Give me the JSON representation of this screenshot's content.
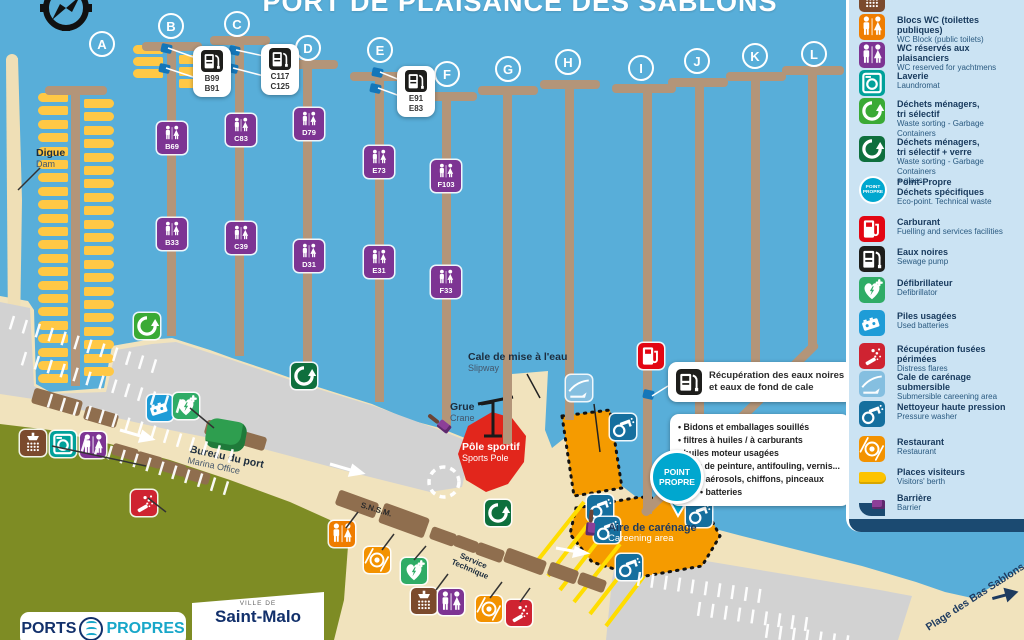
{
  "title": "PORT DE PLAISANCE DES SABLONS",
  "colors": {
    "water": "#58aed9",
    "sand": "#f1e3bd",
    "pontoon": "#b39579",
    "parking": "#d2d2d2",
    "grass": "#7e8c24",
    "legend_bg": "#cbe3f3",
    "navy": "#17395c",
    "orange_zone": "#f59b00",
    "red_zone": "#e2261c",
    "berth_yellow": "#ffc845"
  },
  "legend": {
    "badge1": "POINT",
    "badge2": "PROPRE",
    "items": [
      {
        "icon": "shower",
        "color": "#7b4a2d",
        "top": 0,
        "fr": "",
        "en": "Sanitary"
      },
      {
        "icon": "wc",
        "color": "#ef7d00",
        "top": 28,
        "fr": "Blocs WC (toilettes publiques)",
        "en": "WC Block (public toilets)"
      },
      {
        "icon": "wc",
        "color": "#7d3493",
        "top": 56,
        "fr": "WC réservés aux plaisanciers",
        "en": "WC reserved for yachtmens"
      },
      {
        "icon": "laundry",
        "color": "#00a19a",
        "top": 84,
        "fr": "Laverie",
        "en": "Laundromat"
      },
      {
        "icon": "recycle",
        "color": "#3aaa35",
        "top": 112,
        "fr": "Déchets ménagers,",
        "fr2": "tri sélectif",
        "en": "Waste sorting - Garbage Containers"
      },
      {
        "icon": "recycle",
        "color": "#0e6f3d",
        "top": 150,
        "fr": "Déchets ménagers,",
        "fr2": "tri sélectif + verre",
        "en": "Waste sorting - Garbage Containers",
        "en2": "+ glass"
      },
      {
        "icon": "pointpropre",
        "color": "#00a7cf",
        "top": 190,
        "fr": "Point-Propre",
        "fr2": "Déchets spécifiques",
        "en": "Eco-point. Technical waste"
      },
      {
        "icon": "fuel",
        "color": "#e30613",
        "top": 230,
        "fr": "Carburant",
        "en": "Fuelling and services facilities"
      },
      {
        "icon": "sewage",
        "color": "#1d1d1b",
        "top": 260,
        "fr": "Eaux noires",
        "en": "Sewage pump"
      },
      {
        "icon": "defib",
        "color": "#2fac66",
        "top": 291,
        "fr": "Défibrillateur",
        "en": "Defibrillator"
      },
      {
        "icon": "battery",
        "color": "#1e9cd7",
        "top": 324,
        "fr": "Piles usagées",
        "en": "Used batteries"
      },
      {
        "icon": "flares",
        "color": "#cf2331",
        "top": 357,
        "fr": "Récupération fusées périmées",
        "en": "Distress flares"
      },
      {
        "icon": "slipway",
        "color": "#85bfe0",
        "top": 385,
        "fr": "Cale de carénage submersible",
        "en": "Submersible careening area"
      },
      {
        "icon": "washer",
        "color": "#156f9e",
        "top": 415,
        "fr": "Nettoyeur haute pression",
        "en": "Pressure washer"
      },
      {
        "icon": "restaurant",
        "color": "#f39200",
        "top": 450,
        "fr": "Restaurant",
        "en": "Restaurant"
      },
      {
        "icon": "berth",
        "color": "#fdc300",
        "top": 480,
        "fr": "Places visiteurs",
        "en": "Visitors' berth"
      },
      {
        "icon": "barrier",
        "color": "#7d3493",
        "top": 506,
        "fr": "Barrière",
        "en": "Barrier"
      }
    ]
  },
  "map_labels": {
    "digue_fr": "Digue",
    "digue_en": "Dam",
    "slipway_fr": "Cale de mise à l'eau",
    "slipway_en": "Slipway",
    "crane_fr": "Grue",
    "crane_en": "Crane",
    "sports_fr": "Pôle sportif",
    "sports_en": "Sports Pole",
    "careening_fr": "Aire de carénage",
    "careening_en": "Careening area",
    "office_fr": "Bureau du port",
    "office_en": "Marina Office",
    "snsm": "S.N.S.M.",
    "service_1": "Service",
    "service_2": "Technique",
    "beach": "Plage des Bas Sablons",
    "badge1": "POINT",
    "badge2": "PROPRE"
  },
  "callouts": {
    "recup_line1": "Récupération des eaux noires",
    "recup_line2": "et eaux de fond de cale",
    "waste_list": [
      "Bidons et emballages souillés",
      "filtres à huiles / à carburants",
      "huiles moteur usagées",
      "pots de peinture, antifouling, vernis...",
      "aérosols, chiffons, pinceaux",
      "batteries"
    ],
    "berth_callouts": [
      {
        "labels": [
          "B99",
          "B91"
        ],
        "x": 193,
        "y": 46
      },
      {
        "labels": [
          "C117",
          "C125"
        ],
        "x": 261,
        "y": 44
      },
      {
        "labels": [
          "E91",
          "E83"
        ],
        "x": 397,
        "y": 66
      }
    ]
  },
  "footer": {
    "pp1": "PORTS",
    "pp2": "PROPRES",
    "ville": "VILLE DE",
    "city": "Saint-Malo"
  },
  "map": {
    "letters": [
      {
        "t": "A",
        "x": 89,
        "y": 31
      },
      {
        "t": "B",
        "x": 158,
        "y": 13
      },
      {
        "t": "C",
        "x": 224,
        "y": 11
      },
      {
        "t": "D",
        "x": 295,
        "y": 35
      },
      {
        "t": "E",
        "x": 367,
        "y": 37
      },
      {
        "t": "F",
        "x": 434,
        "y": 61
      },
      {
        "t": "G",
        "x": 495,
        "y": 56
      },
      {
        "t": "H",
        "x": 555,
        "y": 49
      },
      {
        "t": "I",
        "x": 628,
        "y": 55
      },
      {
        "t": "J",
        "x": 684,
        "y": 48
      },
      {
        "t": "K",
        "x": 742,
        "y": 43
      },
      {
        "t": "L",
        "x": 801,
        "y": 41
      }
    ],
    "pontoons": [
      {
        "bx": 45,
        "by": 86,
        "bw": 62,
        "sx": 71,
        "sy": 86,
        "sl": 300
      },
      {
        "bx": 142,
        "by": 42,
        "bw": 60,
        "sx": 167,
        "sy": 42,
        "sl": 294
      },
      {
        "bx": 210,
        "by": 36,
        "bw": 60,
        "sx": 235,
        "sy": 36,
        "sl": 320
      },
      {
        "bx": 278,
        "by": 60,
        "bw": 60,
        "sx": 303,
        "sy": 60,
        "sl": 318
      },
      {
        "bx": 350,
        "by": 72,
        "bw": 60,
        "sx": 375,
        "sy": 72,
        "sl": 330
      },
      {
        "bx": 417,
        "by": 92,
        "bw": 60,
        "sx": 442,
        "sy": 92,
        "sl": 334
      },
      {
        "bx": 478,
        "by": 86,
        "bw": 60,
        "sx": 503,
        "sy": 86,
        "sl": 358
      },
      {
        "bx": 540,
        "by": 80,
        "bw": 60,
        "sx": 565,
        "sy": 80,
        "sl": 340
      },
      {
        "bx": 612,
        "by": 84,
        "bw": 64,
        "sx": 643,
        "sy": 84,
        "sl": 430
      },
      {
        "bx": 668,
        "by": 78,
        "bw": 60,
        "sx": 695,
        "sy": 78,
        "sl": 384
      },
      {
        "bx": 726,
        "by": 72,
        "bw": 60,
        "sx": 751,
        "sy": 72,
        "sl": 330
      },
      {
        "bx": 782,
        "by": 66,
        "bw": 62,
        "sx": 808,
        "sy": 66,
        "sl": 280
      }
    ],
    "walkway": {
      "x": 643,
      "y": 510,
      "len": 244,
      "rot": -44.6
    },
    "wc_markers": [
      {
        "label": "B69",
        "x": 157,
        "y": 122
      },
      {
        "label": "C83",
        "x": 226,
        "y": 114
      },
      {
        "label": "D79",
        "x": 294,
        "y": 108
      },
      {
        "label": "E73",
        "x": 364,
        "y": 146
      },
      {
        "label": "F103",
        "x": 431,
        "y": 160
      },
      {
        "label": "B33",
        "x": 157,
        "y": 218
      },
      {
        "label": "C39",
        "x": 226,
        "y": 222
      },
      {
        "label": "D31",
        "x": 294,
        "y": 240
      },
      {
        "label": "E31",
        "x": 364,
        "y": 246
      },
      {
        "label": "F33",
        "x": 431,
        "y": 266
      }
    ],
    "icons": [
      {
        "t": "recycle",
        "x": 134,
        "y": 313
      },
      {
        "t": "recycle2",
        "x": 291,
        "y": 363
      },
      {
        "t": "battery",
        "x": 147,
        "y": 395
      },
      {
        "t": "defib",
        "x": 173,
        "y": 393
      },
      {
        "t": "shower",
        "x": 20,
        "y": 430
      },
      {
        "t": "laundry",
        "x": 50,
        "y": 431
      },
      {
        "t": "wc",
        "x": 80,
        "y": 432
      },
      {
        "t": "flares",
        "x": 131,
        "y": 490
      },
      {
        "t": "wcpub",
        "x": 329,
        "y": 521
      },
      {
        "t": "restaurant",
        "x": 364,
        "y": 547
      },
      {
        "t": "defib",
        "x": 401,
        "y": 558
      },
      {
        "t": "shower",
        "x": 411,
        "y": 588
      },
      {
        "t": "wc",
        "x": 438,
        "y": 589
      },
      {
        "t": "restaurant",
        "x": 476,
        "y": 596
      },
      {
        "t": "flares",
        "x": 506,
        "y": 600
      },
      {
        "t": "recycle2",
        "x": 485,
        "y": 500
      },
      {
        "t": "fuel",
        "x": 638,
        "y": 343
      },
      {
        "t": "washer",
        "x": 587,
        "y": 495
      },
      {
        "t": "washer",
        "x": 594,
        "y": 517
      },
      {
        "t": "washer",
        "x": 616,
        "y": 554
      },
      {
        "t": "washer",
        "x": 686,
        "y": 501
      },
      {
        "t": "washer",
        "x": 610,
        "y": 414
      },
      {
        "t": "slipway",
        "x": 566,
        "y": 375
      }
    ],
    "icon_colors": {
      "wc": "#7d3493",
      "wcpub": "#ef7d00",
      "laundry": "#00a19a",
      "recycle": "#3aaa35",
      "recycle2": "#0e6f3d",
      "fuel": "#e30613",
      "sewage": "#1d1d1b",
      "defib": "#2fac66",
      "battery": "#1e9cd7",
      "flares": "#cf2331",
      "slipway": "#85bfe0",
      "washer": "#156f9e",
      "restaurant": "#f39200",
      "shower": "#7b4a2d"
    },
    "blue_markers": [
      {
        "x": 161,
        "y": 44
      },
      {
        "x": 159,
        "y": 64
      },
      {
        "x": 229,
        "y": 46
      },
      {
        "x": 227,
        "y": 64
      },
      {
        "x": 372,
        "y": 68
      },
      {
        "x": 370,
        "y": 84
      },
      {
        "x": 643,
        "y": 390
      }
    ],
    "barriers": [
      {
        "x": 426,
        "y": 418,
        "rot": 38
      },
      {
        "x": 578,
        "y": 518,
        "rot": 95
      }
    ],
    "buildings": [
      {
        "x": 32,
        "y": 394,
        "w": 50,
        "h": 16,
        "r": 16
      },
      {
        "x": 84,
        "y": 410,
        "w": 34,
        "h": 14,
        "r": 16
      },
      {
        "x": 112,
        "y": 446,
        "w": 26,
        "h": 12,
        "r": 16
      },
      {
        "x": 136,
        "y": 454,
        "w": 26,
        "h": 12,
        "r": 16
      },
      {
        "x": 160,
        "y": 462,
        "w": 26,
        "h": 12,
        "r": 16
      },
      {
        "x": 184,
        "y": 470,
        "w": 26,
        "h": 12,
        "r": 16
      },
      {
        "x": 205,
        "y": 424,
        "w": 36,
        "h": 15,
        "r": 16
      },
      {
        "x": 240,
        "y": 434,
        "w": 26,
        "h": 14,
        "r": 16
      },
      {
        "x": 336,
        "y": 496,
        "w": 42,
        "h": 16,
        "r": 20
      },
      {
        "x": 380,
        "y": 510,
        "w": 48,
        "h": 21,
        "r": 20
      },
      {
        "x": 430,
        "y": 530,
        "w": 26,
        "h": 13,
        "r": 20
      },
      {
        "x": 454,
        "y": 538,
        "w": 24,
        "h": 12,
        "r": 20
      },
      {
        "x": 476,
        "y": 546,
        "w": 28,
        "h": 13,
        "r": 20
      },
      {
        "x": 504,
        "y": 554,
        "w": 42,
        "h": 15,
        "r": 20
      },
      {
        "x": 548,
        "y": 566,
        "w": 30,
        "h": 14,
        "r": 20
      },
      {
        "x": 578,
        "y": 576,
        "w": 28,
        "h": 13,
        "r": 20
      }
    ],
    "boat_rows": [
      {
        "x": 38,
        "y": 93,
        "n": 22,
        "dy": 13.4,
        "dir": "r"
      },
      {
        "x": 84,
        "y": 99,
        "n": 21,
        "dy": 13.4,
        "dir": "l"
      },
      {
        "x": 133,
        "y": 45,
        "n": 3,
        "dy": 12,
        "dir": "r"
      },
      {
        "x": 179,
        "y": 55,
        "n": 3,
        "dy": 12,
        "dir": "l"
      }
    ],
    "stripe_rows": [
      {
        "x": 14,
        "y": 316,
        "n": 12,
        "a": 17
      },
      {
        "x": 26,
        "y": 352,
        "n": 13,
        "a": 17
      },
      {
        "x": 52,
        "y": 394,
        "n": 15,
        "a": 17
      },
      {
        "x": 86,
        "y": 438,
        "n": 12,
        "a": 17
      },
      {
        "x": 640,
        "y": 572,
        "n": 10,
        "a": 8
      },
      {
        "x": 700,
        "y": 602,
        "n": 9,
        "a": 8
      },
      {
        "x": 768,
        "y": 624,
        "n": 7,
        "a": 8
      }
    ],
    "pointer_lines": [
      {
        "x1": 196,
        "y1": 58,
        "x2": 168,
        "y2": 48,
        "c": "#ffffff"
      },
      {
        "x1": 196,
        "y1": 78,
        "x2": 166,
        "y2": 68,
        "c": "#ffffff"
      },
      {
        "x1": 264,
        "y1": 56,
        "x2": 236,
        "y2": 50,
        "c": "#ffffff"
      },
      {
        "x1": 264,
        "y1": 76,
        "x2": 233,
        "y2": 68,
        "c": "#ffffff"
      },
      {
        "x1": 400,
        "y1": 80,
        "x2": 380,
        "y2": 72,
        "c": "#ffffff"
      },
      {
        "x1": 400,
        "y1": 96,
        "x2": 378,
        "y2": 88,
        "c": "#ffffff"
      },
      {
        "x1": 668,
        "y1": 386,
        "x2": 652,
        "y2": 396,
        "c": "#ffffff"
      },
      {
        "x1": 40,
        "y1": 168,
        "x2": 18,
        "y2": 190,
        "c": "#333333"
      },
      {
        "x1": 527,
        "y1": 374,
        "x2": 540,
        "y2": 398,
        "c": "#222222"
      },
      {
        "x1": 594,
        "y1": 404,
        "x2": 600,
        "y2": 452,
        "c": "#222222"
      },
      {
        "x1": 190,
        "y1": 408,
        "x2": 214,
        "y2": 428,
        "c": "#333333"
      },
      {
        "x1": 52,
        "y1": 446,
        "x2": 146,
        "y2": 466,
        "c": "#333333"
      },
      {
        "x1": 148,
        "y1": 498,
        "x2": 166,
        "y2": 512,
        "c": "#333333"
      },
      {
        "x1": 346,
        "y1": 528,
        "x2": 358,
        "y2": 512,
        "c": "#333333"
      },
      {
        "x1": 382,
        "y1": 550,
        "x2": 394,
        "y2": 534,
        "c": "#333333"
      },
      {
        "x1": 414,
        "y1": 560,
        "x2": 426,
        "y2": 546,
        "c": "#333333"
      },
      {
        "x1": 436,
        "y1": 590,
        "x2": 448,
        "y2": 574,
        "c": "#333333"
      },
      {
        "x1": 490,
        "y1": 598,
        "x2": 502,
        "y2": 582,
        "c": "#333333"
      },
      {
        "x1": 520,
        "y1": 602,
        "x2": 530,
        "y2": 588,
        "c": "#333333"
      }
    ]
  }
}
